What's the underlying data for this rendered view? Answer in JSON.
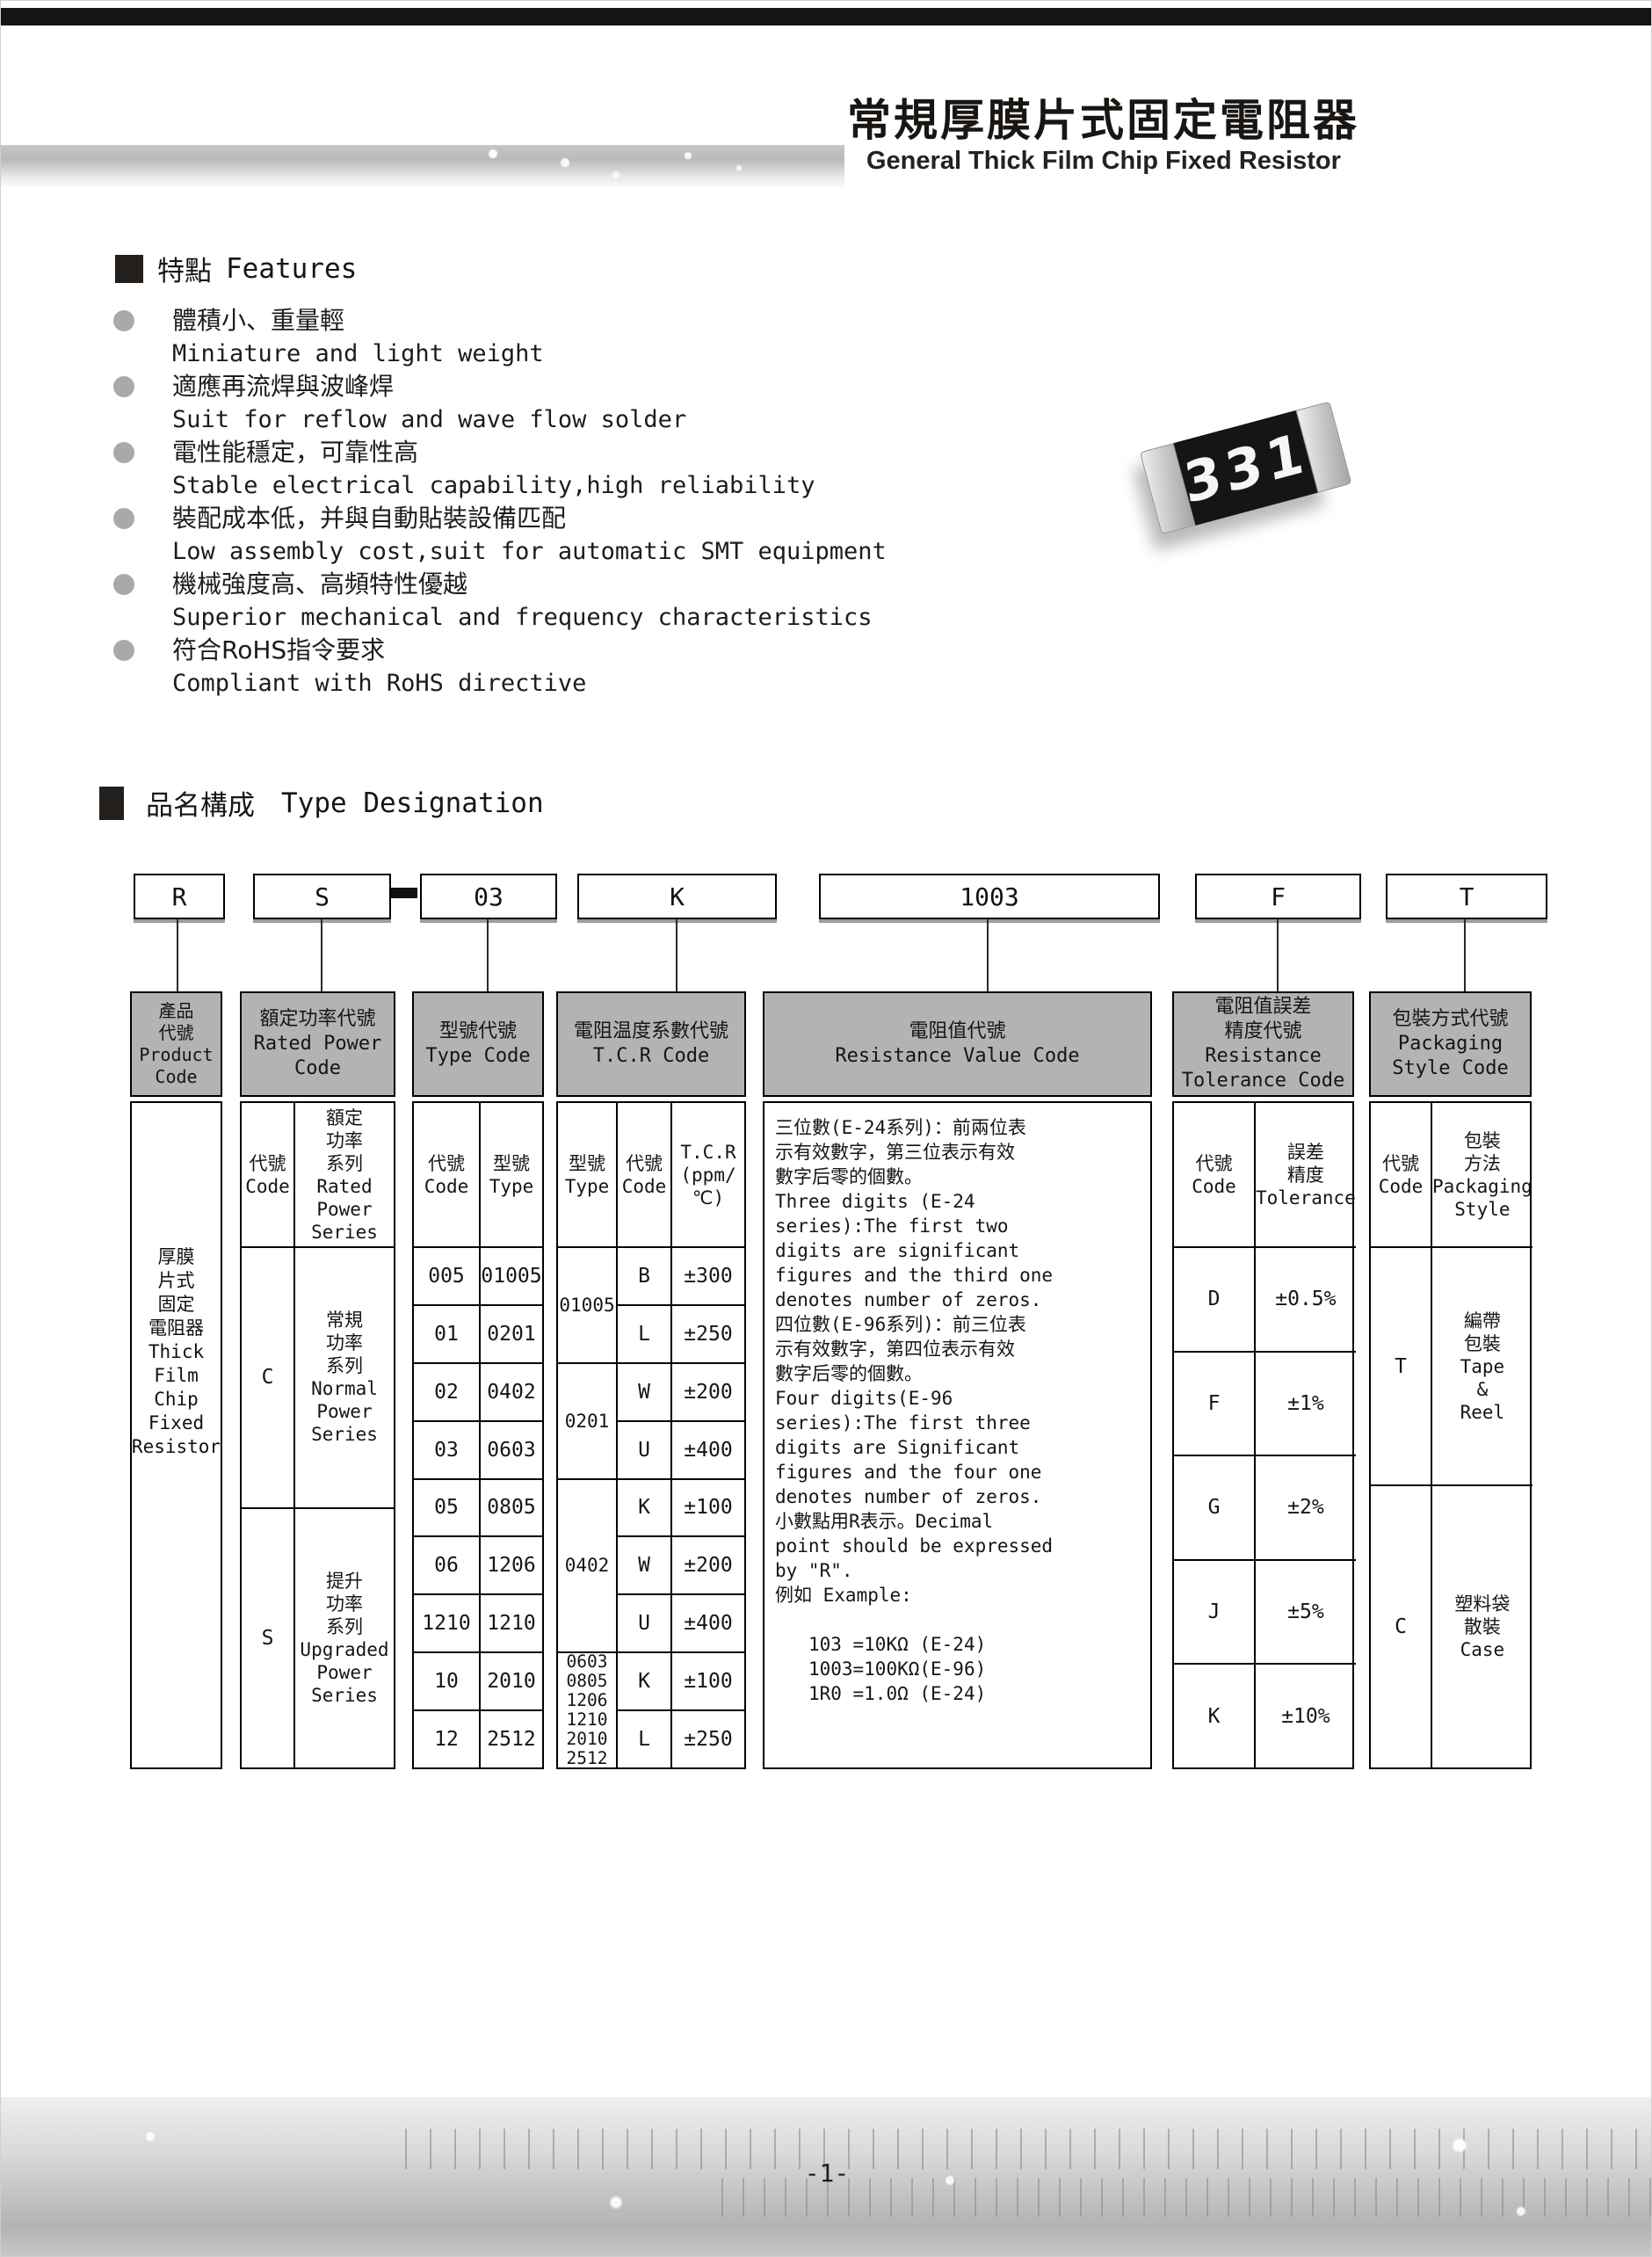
{
  "header": {
    "title_cn": "常規厚膜片式固定電阻器",
    "title_en": "General Thick Film Chip Fixed Resistor"
  },
  "resistor": {
    "marking": "331"
  },
  "features": {
    "heading_cn": "特點",
    "heading_en": "Features",
    "items": [
      {
        "cn": "體積小、重量輕",
        "en": "Miniature and light weight"
      },
      {
        "cn": "適應再流焊與波峰焊",
        "en": "Suit for reflow and wave flow solder"
      },
      {
        "cn": "電性能穩定，可靠性高",
        "en": "Stable electrical capability,high reliability"
      },
      {
        "cn": "裝配成本低，并與自動貼裝設備匹配",
        "en": "Low assembly cost,suit for automatic SMT equipment"
      },
      {
        "cn": "機械強度高、高頻特性優越",
        "en": "Superior mechanical and frequency characteristics"
      },
      {
        "cn": "符合RoHS指令要求",
        "en": "Compliant with RoHS directive"
      }
    ]
  },
  "designation": {
    "heading_cn": "品名構成",
    "heading_en": "Type Designation",
    "boxes": [
      "R",
      "S",
      "03",
      "K",
      "1003",
      "F",
      "T"
    ],
    "product": {
      "header": "產品\n代號\nProduct\nCode",
      "body": "厚膜\n片式\n固定\n電阻器\nThick\nFilm\nChip\nFixed\nResistor"
    },
    "rated_power": {
      "header": "額定功率代號\nRated Power\nCode",
      "sub_code": "代號\nCode",
      "sub_series": "額定\n功率\n系列\nRated\nPower\nSeries",
      "rows": [
        {
          "code": "C",
          "series": "常規\n功率\n系列\nNormal\nPower\nSeries"
        },
        {
          "code": "S",
          "series": "提升\n功率\n系列\nUpgraded\nPower\nSeries"
        }
      ]
    },
    "type_code": {
      "header": "型號代號\nType Code",
      "sub_code": "代號\nCode",
      "sub_type": "型號\nType",
      "rows": [
        [
          "005",
          "01005"
        ],
        [
          "01",
          "0201"
        ],
        [
          "02",
          "0402"
        ],
        [
          "03",
          "0603"
        ],
        [
          "05",
          "0805"
        ],
        [
          "06",
          "1206"
        ],
        [
          "1210",
          "1210"
        ],
        [
          "10",
          "2010"
        ],
        [
          "12",
          "2512"
        ]
      ]
    },
    "tcr": {
      "header": "電阻温度系數代號\nT.C.R Code",
      "sub_type": "型號\nType",
      "sub_code": "代號\nCode",
      "sub_tcr": "T.C.R\n(ppm/℃)",
      "groups": [
        {
          "type": "01005",
          "rows": [
            [
              "B",
              "±300"
            ],
            [
              "L",
              "±250"
            ]
          ]
        },
        {
          "type": "0201",
          "rows": [
            [
              "W",
              "±200"
            ],
            [
              "U",
              "±400"
            ]
          ]
        },
        {
          "type": "0402",
          "rows": [
            [
              "K",
              "±100"
            ],
            [
              "W",
              "±200"
            ],
            [
              "U",
              "±400"
            ]
          ]
        },
        {
          "type": "0603\n0805\n1206\n1210\n2010\n2512",
          "rows": [
            [
              "K",
              "±100"
            ],
            [
              "L",
              "±250"
            ]
          ]
        }
      ]
    },
    "resistance": {
      "header": "電阻值代號\nResistance Value Code",
      "body": "三位數(E-24系列)：前兩位表\n示有效數字，第三位表示有效\n數字后零的個數。\nThree digits (E-24\nseries):The first two\ndigits are significant\nfigures and the third one\ndenotes number of zeros.\n四位數(E-96系列)：前三位表\n示有效數字，第四位表示有效\n數字后零的個數。\nFour digits(E-96\nseries):The first three\ndigits are Significant\nfigures and the four one\ndenotes number of zeros.\n小數點用R表示。Decimal\npoint should be expressed\nby \"R\".\n例如 Example:\n\n   103 =10KΩ (E-24)\n   1003=100KΩ(E-96)\n   1R0 =1.0Ω (E-24)"
    },
    "tolerance": {
      "header": "電阻值誤差\n精度代號\nResistance\nTolerance Code",
      "sub_code": "代號\nCode",
      "sub_tol": "誤差\n精度\nTolerance",
      "rows": [
        [
          "D",
          "±0.5%"
        ],
        [
          "F",
          "±1%"
        ],
        [
          "G",
          "±2%"
        ],
        [
          "J",
          "±5%"
        ],
        [
          "K",
          "±10%"
        ]
      ]
    },
    "packaging": {
      "header": "包裝方式代號\nPackaging\nStyle Code",
      "sub_code": "代號\nCode",
      "sub_style": "包裝\n方法\nPackaging\nStyle",
      "rows": [
        {
          "code": "T",
          "style": "編帶\n包裝\nTape\n&\nReel"
        },
        {
          "code": "C",
          "style": "塑料袋\n散裝\nCase"
        }
      ]
    }
  },
  "footer": {
    "page_number": "-1-"
  }
}
